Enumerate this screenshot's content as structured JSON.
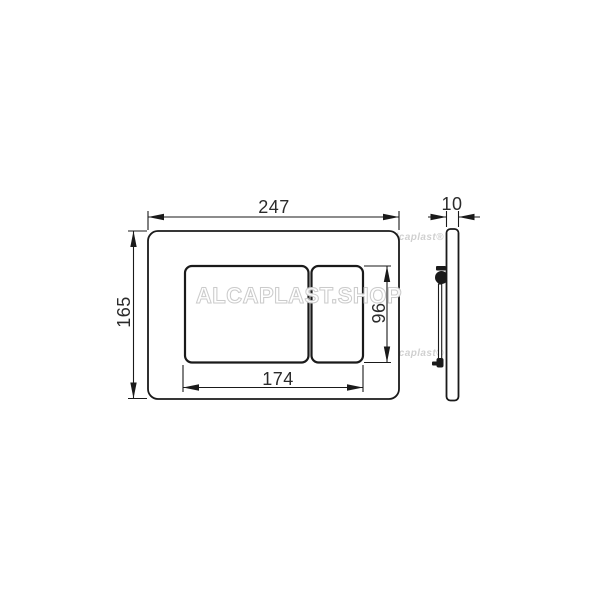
{
  "dims": {
    "front_width": "247",
    "front_height": "165",
    "buttons_width": "174",
    "buttons_height": "96",
    "side_thickness": "10"
  },
  "watermarks": {
    "large": "ALCAPLAST.SHOP",
    "small": "Alcaplast®"
  },
  "colors": {
    "line": "#1a1a1a",
    "dim_text": "#2b2b2b",
    "watermark_light": "#c9c9c9",
    "background": "#ffffff"
  }
}
